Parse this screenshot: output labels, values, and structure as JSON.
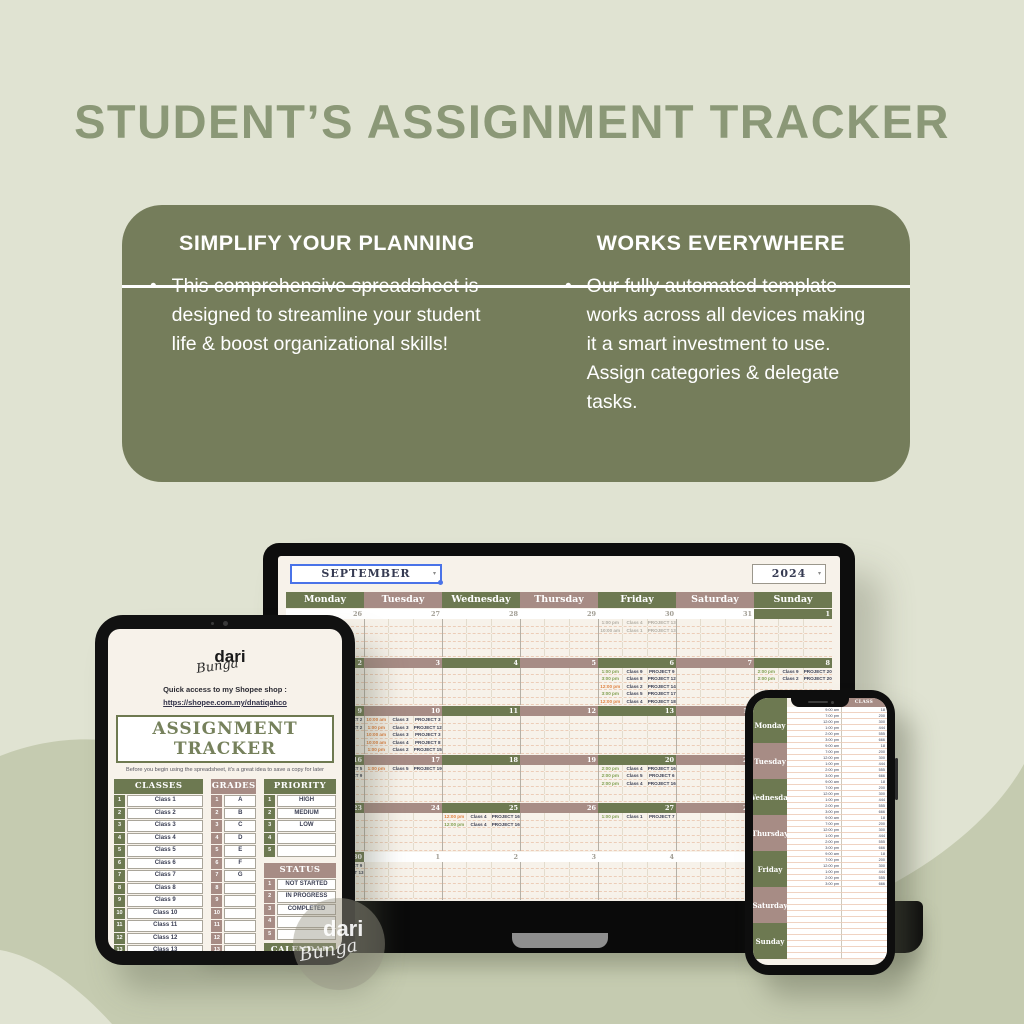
{
  "page": {
    "title": "STUDENT’S ASSIGNMENT TRACKER"
  },
  "promo_card": {
    "left": {
      "heading": "SIMPLIFY YOUR PLANNING",
      "bullet": "This comprehensive spreadsheet is designed to streamline your student life & boost organizational skills!"
    },
    "right": {
      "heading": "WORKS EVERYWHERE",
      "bullet": "Our fully automated template works across all devices making it a smart investment to use. Assign categories & delegate tasks."
    }
  },
  "colors": {
    "background": "#e0e3d2",
    "blob": "#c5cbb0",
    "title_green": "#8b9877",
    "card_green": "#757d5b",
    "header_green": "#6d7951",
    "header_mauve": "#a78c85",
    "screen_cream": "#f7f2ea",
    "ink_navy": "#363b52",
    "time_orange": "#df8140",
    "time_green": "#7f9f50",
    "selection_blue": "#4a73e8"
  },
  "laptop": {
    "month": "SEPTEMBER",
    "year": "2024",
    "day_headers": [
      "Monday",
      "Tuesday",
      "Wednesday",
      "Thursday",
      "Friday",
      "Saturday",
      "Sunday"
    ],
    "shades": [
      "g",
      "m",
      "g",
      "m",
      "g",
      "m",
      "g"
    ],
    "weeks": [
      {
        "dates": [
          {
            "n": "26",
            "m": 1
          },
          {
            "n": "27",
            "m": 1
          },
          {
            "n": "28",
            "m": 1
          },
          {
            "n": "29",
            "m": 1
          },
          {
            "n": "30",
            "m": 1
          },
          {
            "n": "31",
            "m": 1
          },
          {
            "n": "1",
            "m": 0
          }
        ],
        "events": {
          "4": [
            [
              "1:00 pm",
              "Class 4",
              "PROJECT 13",
              "x"
            ],
            [
              "10:00 am",
              "Class 1",
              "PROJECT 13",
              "x"
            ]
          ]
        }
      },
      {
        "dates": [
          {
            "n": "2",
            "m": 0
          },
          {
            "n": "3",
            "m": 0
          },
          {
            "n": "4",
            "m": 0
          },
          {
            "n": "5",
            "m": 0
          },
          {
            "n": "6",
            "m": 0
          },
          {
            "n": "7",
            "m": 0
          },
          {
            "n": "8",
            "m": 0
          }
        ],
        "events": {
          "4": [
            [
              "1:00 pm",
              "Class 9",
              "PROJECT 9",
              "g"
            ],
            [
              "3:00 pm",
              "Class 8",
              "PROJECT 12",
              "g"
            ],
            [
              "12:00 pm",
              "Class 2",
              "PROJECT 14",
              "o"
            ],
            [
              "3:00 pm",
              "Class 5",
              "PROJECT 17",
              "g"
            ],
            [
              "12:00 pm",
              "Class 4",
              "PROJECT 18",
              "o"
            ]
          ],
          "6": [
            [
              "2:00 pm",
              "Class 9",
              "PROJECT 20",
              "g"
            ],
            [
              "2:00 pm",
              "Class 2",
              "PROJECT 20",
              "g"
            ]
          ]
        }
      },
      {
        "dates": [
          {
            "n": "9",
            "m": 0
          },
          {
            "n": "10",
            "m": 0
          },
          {
            "n": "11",
            "m": 0
          },
          {
            "n": "12",
            "m": 0
          },
          {
            "n": "13",
            "m": 0
          },
          {
            "n": "14",
            "m": 0
          },
          {
            "n": "15",
            "m": 0
          }
        ],
        "events": {
          "0": [
            [
              "9:00 am",
              "Class 2",
              "PROJECT 2",
              "o"
            ],
            [
              "1:00 pm",
              "Class 2",
              "PROJECT 2",
              "o"
            ]
          ],
          "1": [
            [
              "10:00 am",
              "Class 3",
              "PROJECT 3",
              "o"
            ],
            [
              "1:00 pm",
              "Class 3",
              "PROJECT 12",
              "o"
            ],
            [
              "10:00 am",
              "Class 3",
              "PROJECT 3",
              "o"
            ],
            [
              "10:00 am",
              "Class 4",
              "PROJECT 8",
              "o"
            ],
            [
              "1:00 pm",
              "Class 2",
              "PROJECT 15",
              "o"
            ]
          ]
        }
      },
      {
        "dates": [
          {
            "n": "16",
            "m": 0
          },
          {
            "n": "17",
            "m": 0
          },
          {
            "n": "18",
            "m": 0
          },
          {
            "n": "19",
            "m": 0
          },
          {
            "n": "20",
            "m": 0
          },
          {
            "n": "21",
            "m": 0
          },
          {
            "n": "22",
            "m": 0
          }
        ],
        "events": {
          "0": [
            [
              "9:00 am",
              "Class 5",
              "PROJECT 5",
              "o"
            ],
            [
              "9:00 am",
              "Class 9",
              "PROJECT 9",
              "o"
            ]
          ],
          "1": [
            [
              "1:00 pm",
              "Class 5",
              "PROJECT 19",
              "o"
            ]
          ],
          "4": [
            [
              "2:00 pm",
              "Class 4",
              "PROJECT 16",
              "g"
            ],
            [
              "2:00 pm",
              "Class 5",
              "PROJECT 6",
              "g"
            ],
            [
              "2:00 pm",
              "Class 4",
              "PROJECT 16",
              "g"
            ]
          ]
        }
      },
      {
        "dates": [
          {
            "n": "23",
            "m": 0
          },
          {
            "n": "24",
            "m": 0
          },
          {
            "n": "25",
            "m": 0
          },
          {
            "n": "26",
            "m": 0
          },
          {
            "n": "27",
            "m": 0
          },
          {
            "n": "28",
            "m": 0
          },
          {
            "n": "29",
            "m": 0
          }
        ],
        "events": {
          "2": [
            [
              "12:00 pm",
              "Class 4",
              "PROJECT 16",
              "o"
            ],
            [
              "12:00 pm",
              "Class 4",
              "PROJECT 16",
              "g"
            ]
          ],
          "4": [
            [
              "1:00 pm",
              "Class 1",
              "PROJECT 7",
              "g"
            ]
          ]
        }
      },
      {
        "dates": [
          {
            "n": "30",
            "m": 0
          },
          {
            "n": "1",
            "m": 1
          },
          {
            "n": "2",
            "m": 1
          },
          {
            "n": "3",
            "m": 1
          },
          {
            "n": "4",
            "m": 1
          },
          {
            "n": "5",
            "m": 1
          },
          {
            "n": "6",
            "m": 1
          }
        ],
        "events": {
          "0": [
            [
              "9:00 am",
              "Class 9",
              "PROJECT 9",
              "o"
            ],
            [
              "1:00 pm",
              "Class 13",
              "PROJECT 13",
              "o"
            ]
          ]
        }
      }
    ]
  },
  "tablet": {
    "brand": {
      "line1": "dari",
      "line2": "Bunga"
    },
    "shopee_label": "Quick access to my Shopee shop :",
    "shopee_link": "https://shopee.com.my/dnatiqahco",
    "title": "ASSIGNMENT TRACKER",
    "subtitle": "Before you begin using the spreadsheet, it's a great idea to save a copy for later",
    "classes": {
      "header": "CLASSES",
      "shade": "g",
      "rows": [
        [
          "1",
          "Class 1"
        ],
        [
          "2",
          "Class 2"
        ],
        [
          "3",
          "Class 3"
        ],
        [
          "4",
          "Class 4"
        ],
        [
          "5",
          "Class 5"
        ],
        [
          "6",
          "Class 6"
        ],
        [
          "7",
          "Class 7"
        ],
        [
          "8",
          "Class 8"
        ],
        [
          "9",
          "Class 9"
        ],
        [
          "10",
          "Class 10"
        ],
        [
          "11",
          "Class 11"
        ],
        [
          "12",
          "Class 12"
        ],
        [
          "13",
          "Class 13"
        ],
        [
          "14",
          "Class 14"
        ],
        [
          "15",
          "Class 15"
        ]
      ]
    },
    "grades": {
      "header": "GRADES",
      "shade": "m",
      "rows": [
        [
          "1",
          "A"
        ],
        [
          "2",
          "B"
        ],
        [
          "3",
          "C"
        ],
        [
          "4",
          "D"
        ],
        [
          "5",
          "E"
        ],
        [
          "6",
          "F"
        ],
        [
          "7",
          "G"
        ],
        [
          "8",
          ""
        ],
        [
          "9",
          ""
        ],
        [
          "10",
          ""
        ],
        [
          "11",
          ""
        ],
        [
          "12",
          ""
        ],
        [
          "13",
          ""
        ],
        [
          "14",
          ""
        ],
        [
          "15",
          ""
        ]
      ]
    },
    "priority": {
      "header": "PRIORITY",
      "shade": "g",
      "rows": [
        [
          "1",
          "HIGH"
        ],
        [
          "2",
          "MEDIUM"
        ],
        [
          "3",
          "LOW"
        ],
        [
          "4",
          ""
        ],
        [
          "5",
          ""
        ]
      ]
    },
    "status": {
      "header": "STATUS",
      "shade": "m",
      "rows": [
        [
          "1",
          "NOT STARTED"
        ],
        [
          "2",
          "IN PROGRESS"
        ],
        [
          "3",
          "COMPLETED"
        ],
        [
          "4",
          ""
        ],
        [
          "5",
          ""
        ]
      ]
    },
    "calendar_start": {
      "header": "CALENDAR START",
      "value": "MONDAY"
    }
  },
  "phone": {
    "class_header": "CLASS",
    "times": [
      "9:00 am",
      "7:00 pm",
      "12:00 pm",
      "1:00 pm",
      "2:00 pm",
      "3:00 pm"
    ],
    "vals": [
      "18",
      "200",
      "300",
      "444",
      "555",
      "666"
    ],
    "days": [
      {
        "label": "Monday",
        "shade": "g",
        "filled": true
      },
      {
        "label": "Tuesday",
        "shade": "m",
        "filled": true
      },
      {
        "label": "Wednesday",
        "shade": "g",
        "filled": true
      },
      {
        "label": "Thursday",
        "shade": "m",
        "filled": true
      },
      {
        "label": "Friday",
        "shade": "g",
        "filled": true
      },
      {
        "label": "Saturday",
        "shade": "m",
        "filled": false
      },
      {
        "label": "Sunday",
        "shade": "g",
        "filled": false
      }
    ]
  },
  "watermark": {
    "line1": "dari",
    "line2": "Bunga"
  },
  "icons": {
    "dropdown_caret": "▾",
    "bullet": "•"
  }
}
